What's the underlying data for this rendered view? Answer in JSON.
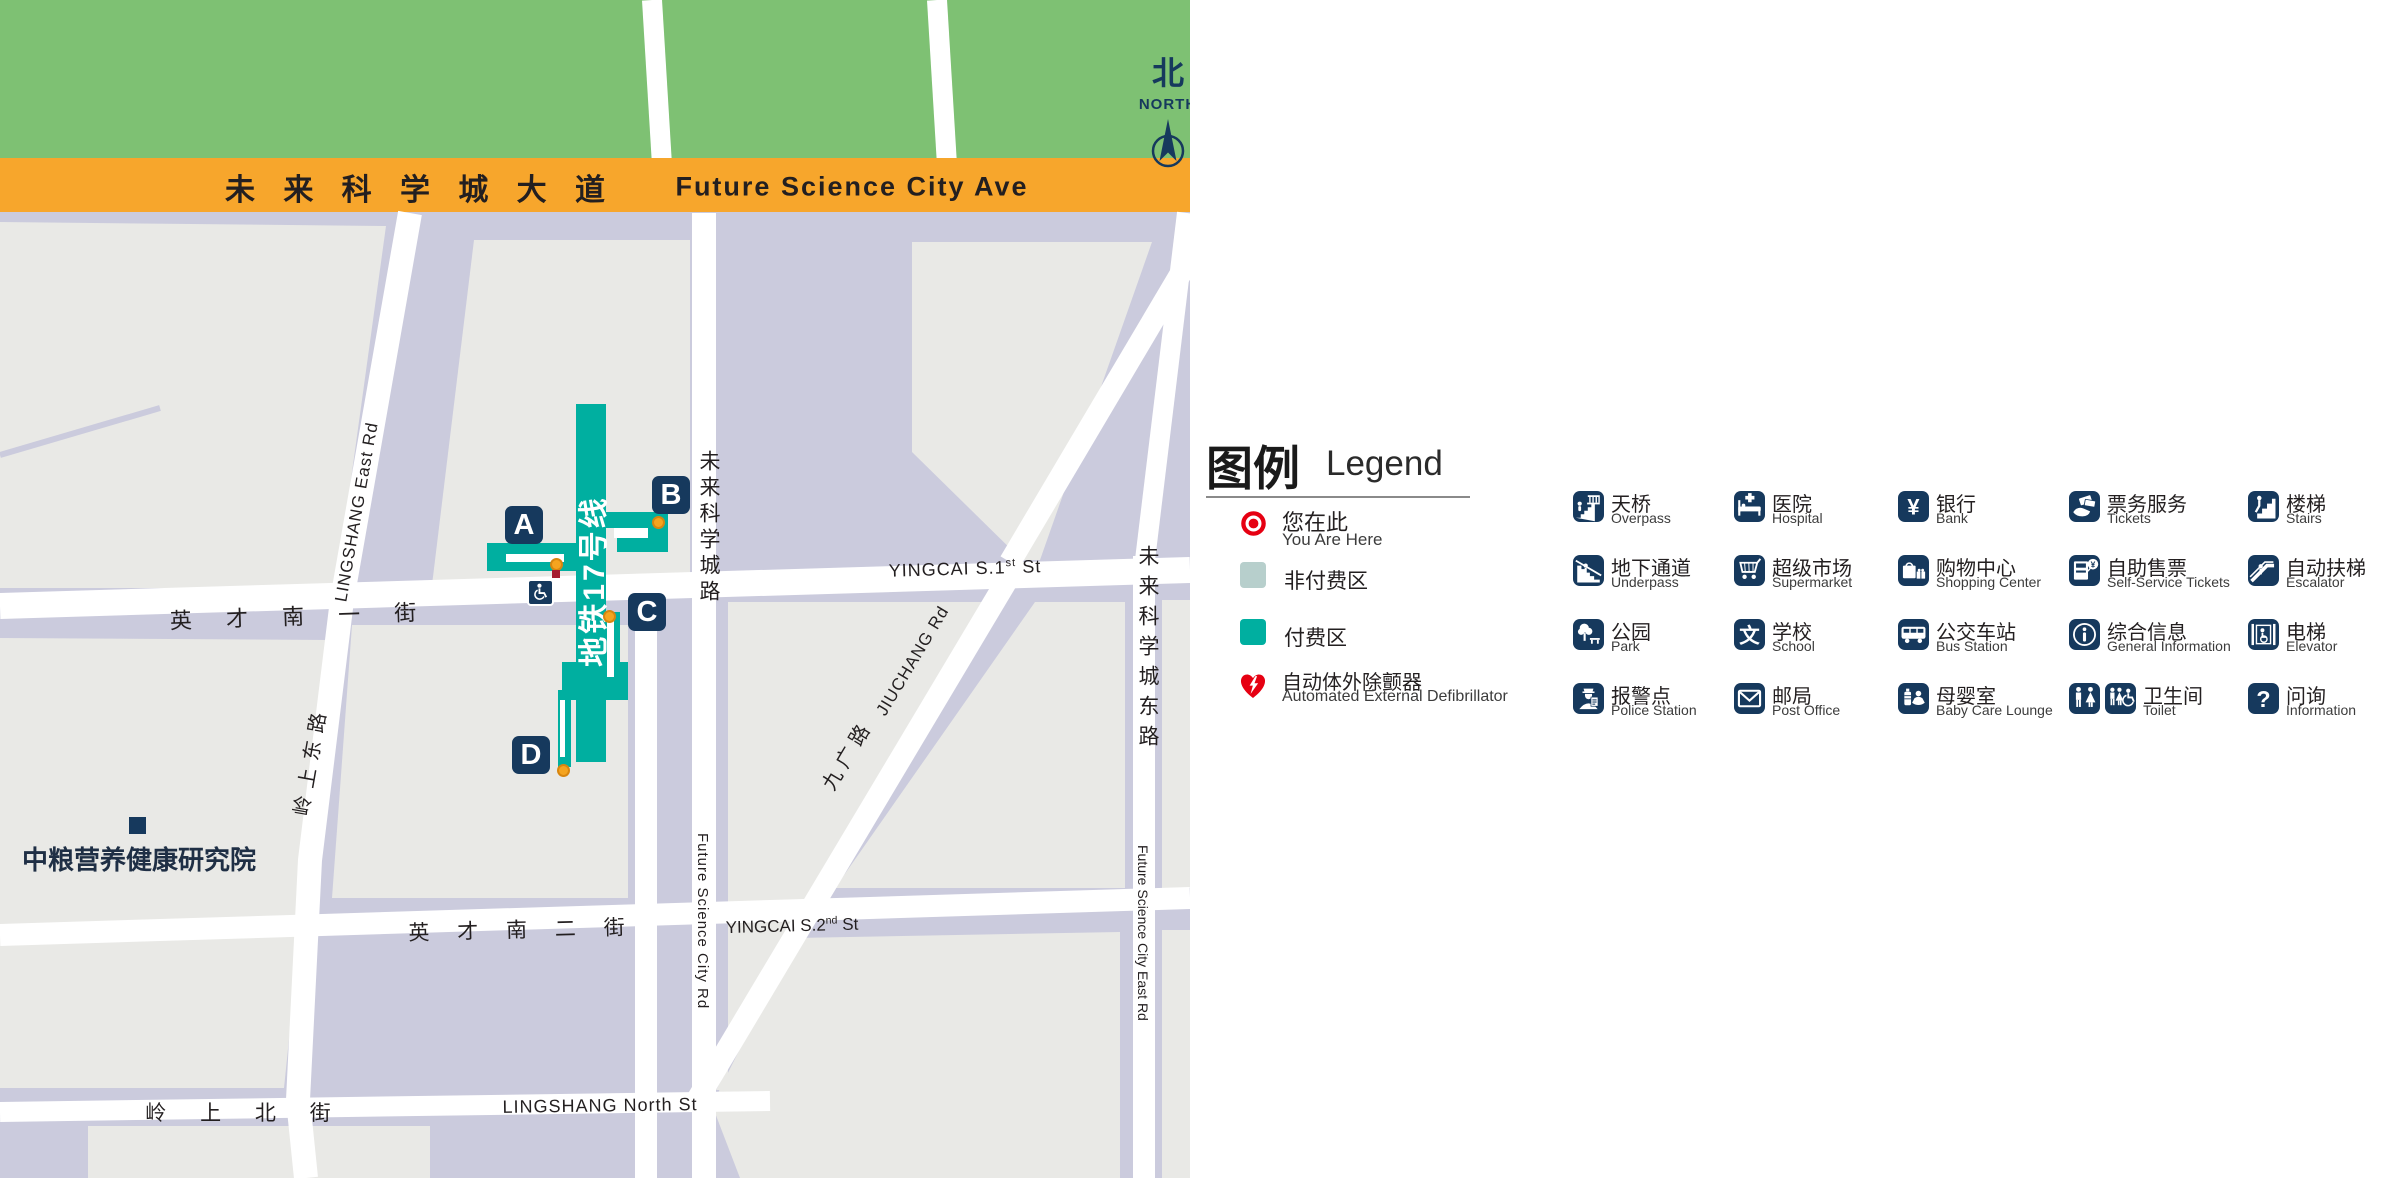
{
  "map": {
    "north": {
      "zh": "北",
      "en": "NORTH"
    },
    "avenue": {
      "zh": "未 来 科 学 城 大 道",
      "en": "Future Science City Ave"
    },
    "roads": {
      "lingshang_east": {
        "en": "LINGSHANG East Rd",
        "zh": "岭上东路"
      },
      "yingcai_s1": {
        "zh": "英 才 南 一 街",
        "en_pre": "YINGCAI S.1",
        "en_sup": "st",
        "en_post": " St"
      },
      "yingcai_s2": {
        "zh": "英 才 南 二 街",
        "en_pre": "YINGCAI S.2",
        "en_sup": "nd",
        "en_post": " St"
      },
      "lingshang_north": {
        "zh": "岭 上 北 街",
        "en": "LINGSHANG North St"
      },
      "future_rd": {
        "zh": "未来科学城路",
        "en": "Future Science City Rd"
      },
      "future_east": {
        "zh": "未来科学城东路",
        "en": "Future Science City East Rd"
      },
      "jiuchang": {
        "zh": "九广路",
        "en": "JIUCHANG Rd"
      }
    },
    "station": {
      "line_label": "地铁17号线",
      "exits": [
        "A",
        "B",
        "C",
        "D"
      ]
    },
    "poi": {
      "cofco": "中粮营养健康研究院"
    }
  },
  "legend": {
    "title_zh": "图例",
    "title_en": "Legend",
    "items": [
      {
        "zh": "您在此",
        "en": "You Are Here",
        "icon": "you-are-here"
      },
      {
        "zh": "非付费区",
        "en": "",
        "icon": "unpaid-area-swatch",
        "color": "#b7cfcc"
      },
      {
        "zh": "付费区",
        "en": "",
        "icon": "paid-area-swatch",
        "color": "#00afa0"
      },
      {
        "zh": "自动体外除颤器",
        "en": "Automated External Defibrillator",
        "icon": "aed"
      }
    ],
    "grid": [
      {
        "zh": "天桥",
        "en": "Overpass",
        "icon": "overpass"
      },
      {
        "zh": "医院",
        "en": "Hospital",
        "icon": "hospital"
      },
      {
        "zh": "银行",
        "en": "Bank",
        "icon": "bank"
      },
      {
        "zh": "票务服务",
        "en": "Tickets",
        "icon": "tickets"
      },
      {
        "zh": "楼梯",
        "en": "Stairs",
        "icon": "stairs"
      },
      {
        "zh": "地下通道",
        "en": "Underpass",
        "icon": "underpass"
      },
      {
        "zh": "超级市场",
        "en": "Supermarket",
        "icon": "supermarket"
      },
      {
        "zh": "购物中心",
        "en": "Shopping Center",
        "icon": "shopping-center"
      },
      {
        "zh": "自助售票",
        "en": "Self-Service Tickets",
        "icon": "self-service-tickets"
      },
      {
        "zh": "自动扶梯",
        "en": "Escalator",
        "icon": "escalator"
      },
      {
        "zh": "公园",
        "en": "Park",
        "icon": "park"
      },
      {
        "zh": "学校",
        "en": "School",
        "icon": "school"
      },
      {
        "zh": "公交车站",
        "en": "Bus Station",
        "icon": "bus-station"
      },
      {
        "zh": "综合信息",
        "en": "General Information",
        "icon": "general-information"
      },
      {
        "zh": "电梯",
        "en": "Elevator",
        "icon": "elevator"
      },
      {
        "zh": "报警点",
        "en": "Police Station",
        "icon": "police-station"
      },
      {
        "zh": "邮局",
        "en": "Post Office",
        "icon": "post-office"
      },
      {
        "zh": "母婴室",
        "en": "Baby Care Lounge",
        "icon": "baby-care-lounge"
      },
      {
        "zh": "卫生间",
        "en": "Toilet",
        "icon": "toilet"
      },
      {
        "zh": "问询",
        "en": "Information",
        "icon": "information"
      }
    ]
  },
  "colors": {
    "paid_area": "#00afa0",
    "unpaid_area": "#b7cfcc",
    "navy_icon": "#16395d",
    "avenue_orange": "#f7a62c",
    "park_green": "#7ec173",
    "block_lavender": "#cbcbdd",
    "building_gray": "#e9e9e6",
    "red": "#e60012",
    "exit_dot_orange": "#f5a41f"
  }
}
